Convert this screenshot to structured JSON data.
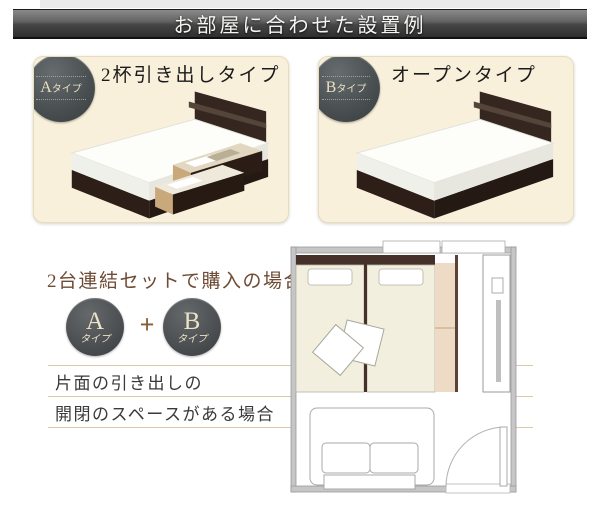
{
  "header": {
    "title": "お部屋に合わせた設置例"
  },
  "panels": [
    {
      "badge_letter": "A",
      "badge_suffix": "タイプ",
      "title": "2杯引き出しタイプ"
    },
    {
      "badge_letter": "B",
      "badge_suffix": "タイプ",
      "title": "オープンタイプ"
    }
  ],
  "bottom": {
    "title": "2台連結セットで購入の場合",
    "circle_a": {
      "letter": "A",
      "suffix": "タイプ"
    },
    "plus": "+",
    "circle_b": {
      "letter": "B",
      "suffix": "タイプ"
    },
    "notes": [
      "片面の引き出しの",
      "開閉のスペースがある場合"
    ]
  },
  "colors": {
    "header_bar_dark": "#3a3a3a",
    "panel_cream": "#f9f0dc",
    "badge_gray": "#4b5052",
    "badge_text_cream": "#e9dfc2",
    "accent_brown": "#6e4b34",
    "plus_brown": "#8a5c36",
    "rule_beige": "#dcc9a8",
    "bed_wood_dark": "#2d1f17",
    "plan_bed_fill": "#f2efde",
    "plan_drawer_space": "#eedbc5"
  }
}
